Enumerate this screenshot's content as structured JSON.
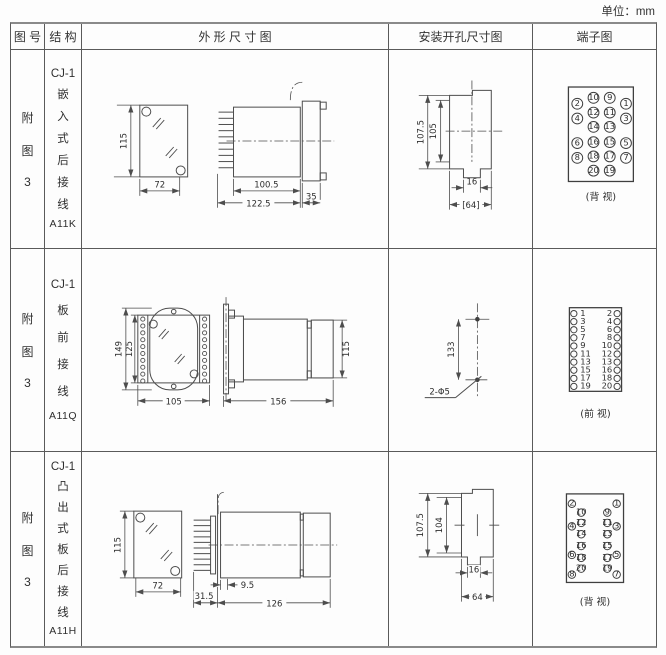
{
  "unit_label": "单位：mm",
  "header": {
    "figure": "图 号",
    "structure": "结 构",
    "outline": "外 形 尺 寸 图",
    "mounting": "安装开孔尺寸图",
    "terminal": "端子图"
  },
  "rows": [
    {
      "figure_chars": [
        "附",
        "图",
        "3"
      ],
      "model": "CJ-1",
      "structure_chars": [
        "嵌",
        "入",
        "式",
        "后",
        "接",
        "线"
      ],
      "code": "A11K",
      "outline": {
        "front_height": "115",
        "front_width": "72",
        "body_len": "100.5",
        "total_len": "122.5",
        "flange": "35"
      },
      "mounting": {
        "outer_height": "107.5",
        "inner_height": "105",
        "slot_width": "16",
        "width": "[64]"
      },
      "terminal_view": "(背 视)"
    },
    {
      "figure_chars": [
        "附",
        "图",
        "3"
      ],
      "model": "CJ-1",
      "structure_chars": [
        "板",
        "前",
        "接",
        "线"
      ],
      "code": "A11Q",
      "outline": {
        "outer_height": "149",
        "inner_height": "125",
        "front_width": "105",
        "body_len": "156",
        "side_height": "115"
      },
      "mounting": {
        "hole_spacing": "133",
        "hole_label": "2-Φ5"
      },
      "terminal_view": "(前 视)"
    },
    {
      "figure_chars": [
        "附",
        "图",
        "3"
      ],
      "model": "CJ-1",
      "structure_chars": [
        "凸",
        "出",
        "式",
        "板",
        "后",
        "接",
        "线"
      ],
      "code": "A11H",
      "outline": {
        "front_height": "115",
        "front_width": "72",
        "pin_len": "31.5",
        "offset": "9.5",
        "body_len": "126"
      },
      "mounting": {
        "outer_height": "107.5",
        "inner_height": "104",
        "slot_width": "16",
        "width": "64"
      },
      "terminal_view": "(背 视)"
    }
  ],
  "terminals": {
    "back_view_1": {
      "inner_left": [
        "10",
        "12",
        "14",
        "16",
        "18",
        "20"
      ],
      "inner_right": [
        "9",
        "11",
        "13",
        "15",
        "17",
        "19"
      ],
      "outer_left": [
        "2",
        "4",
        "6",
        "8"
      ],
      "outer_right": [
        "1",
        "3",
        "5",
        "7"
      ]
    },
    "front_view": {
      "left": [
        "1",
        "3",
        "5",
        "7",
        "9",
        "11",
        "13",
        "15",
        "17",
        "19"
      ],
      "right": [
        "2",
        "4",
        "6",
        "8",
        "10",
        "12",
        "13",
        "16",
        "18",
        "20"
      ]
    },
    "back_view_3": {
      "inner_left": [
        "10",
        "12",
        "14",
        "16",
        "18",
        "20"
      ],
      "inner_right": [
        "9",
        "11",
        "13",
        "15",
        "17",
        "19"
      ],
      "outer_left": [
        "2",
        "4",
        "6",
        "8"
      ],
      "outer_right": [
        "1",
        "3",
        "5",
        "7"
      ]
    }
  }
}
